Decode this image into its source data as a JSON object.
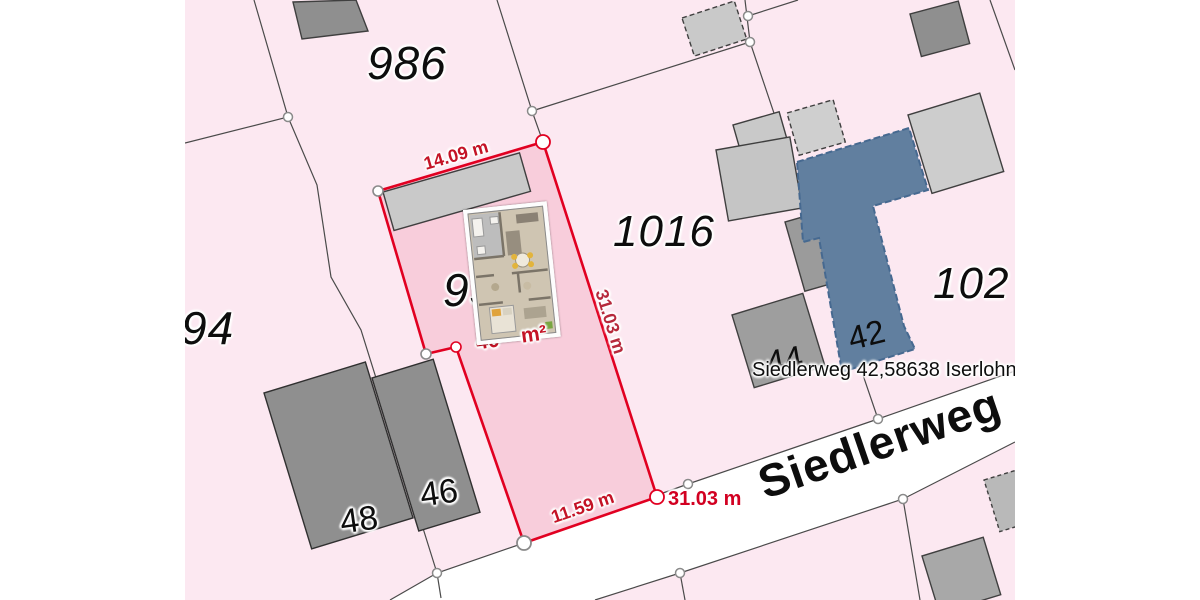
{
  "map": {
    "parcel_labels": {
      "p986": "986",
      "p1016": "1016",
      "p94": "94",
      "p102": "102",
      "p93": "93"
    },
    "house_numbers": {
      "h48": "48",
      "h46": "46",
      "h44": "44",
      "h42": "42"
    },
    "measurements": {
      "top_edge": "14.09 m",
      "right_edge": "31.03 m",
      "bottom_edge": "11.59 m",
      "corner_total": "31.03 m"
    },
    "area_label": {
      "visible_left": "40",
      "visible_right": "m²"
    },
    "street_name": "Siedlerweg",
    "address_label": "Siedlerweg 42,58638 Iserlohn",
    "colors": {
      "background_pink": "#fce8f1",
      "highlight_parcel_fill": "#f8cddb",
      "highlight_parcel_stroke": "#e10021",
      "street_white": "#ffffff",
      "building_dark": "#8f8f8f",
      "building_medium": "#9e9e9e",
      "building_light": "#c9c9c9",
      "selected_building_fill": "#617f9f",
      "selected_building_stroke": "#466990",
      "measurement_red": "#c41326"
    }
  }
}
